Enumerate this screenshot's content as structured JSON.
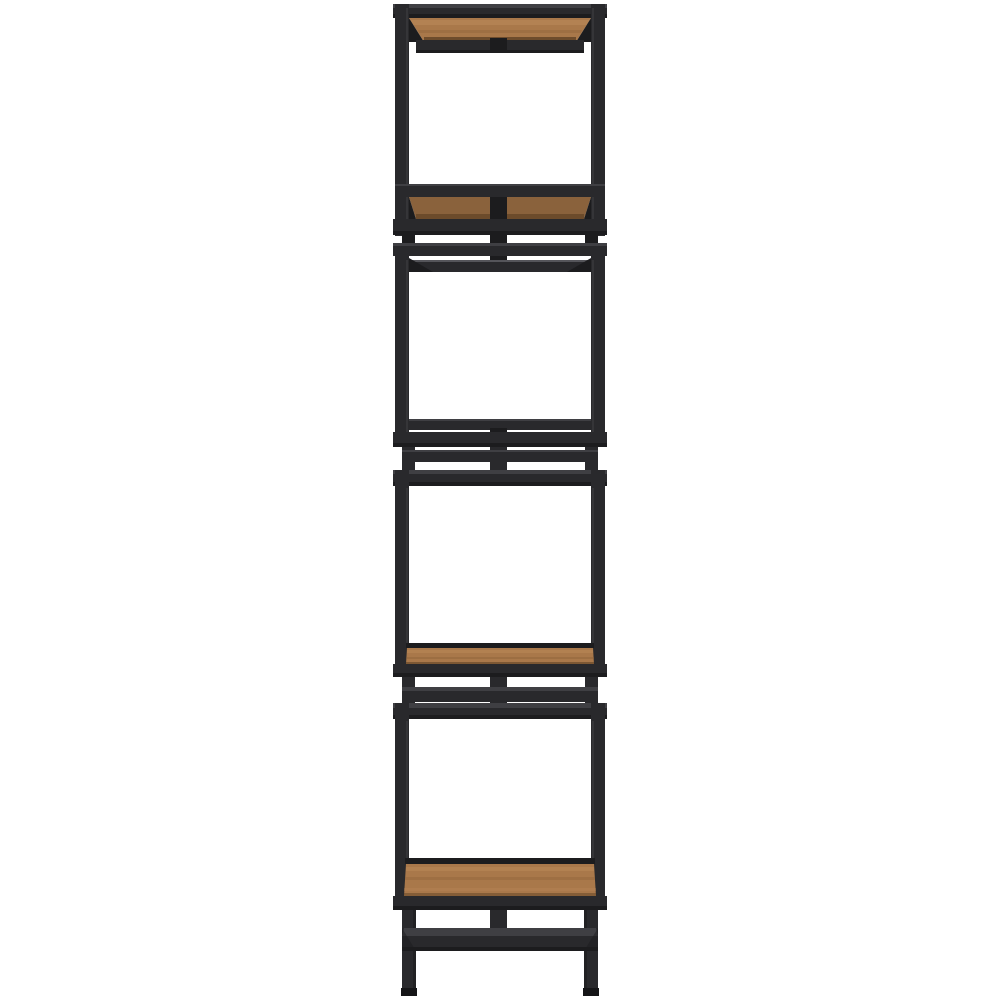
{
  "image": {
    "type": "product-photo",
    "subject": "Tall narrow industrial etagere tower bookshelf with black metal frame and brown wood shelves on a white background",
    "frame_material": "black metal",
    "shelf_material": "brown wood",
    "open_cube_sections": 4,
    "wood_shelves_visible": 4,
    "view": "front",
    "background": "white"
  },
  "colors": {
    "background": "#ffffff",
    "frame": "#29292c",
    "frame_dark": "#1c1c1e",
    "frame_deep": "#151517",
    "frame_light": "#3f3f43",
    "frame_highlight": "#55555a",
    "wood": "#a9784a",
    "wood_light": "#bd8c5c",
    "wood_dark": "#8a5f36",
    "wood_shadow": "#5f4124"
  }
}
